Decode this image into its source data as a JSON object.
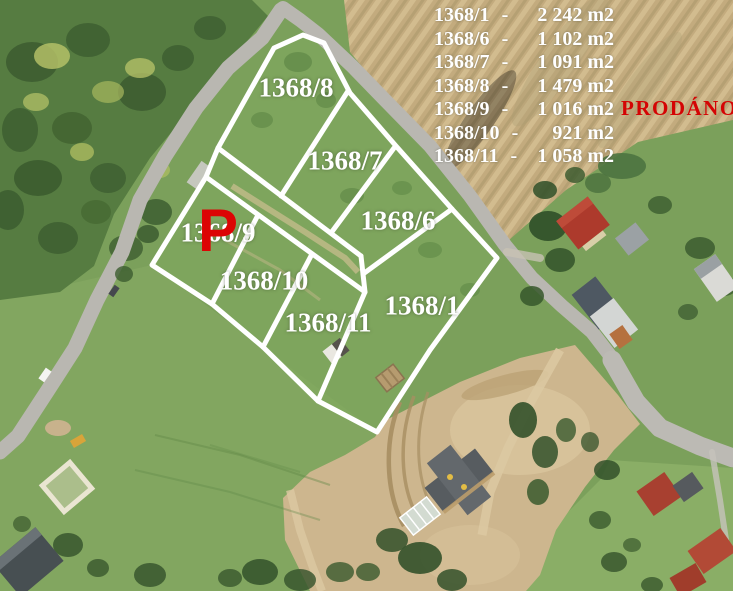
{
  "colors": {
    "grass": "#7ba05b",
    "forest": "#567c41",
    "plowed_field": "#c3ab7e",
    "road": "#b9b7b1",
    "construction_dirt": "#cdb68e",
    "boundary_line": "#ffffff",
    "label_text": "#ffffff",
    "sold_red": "#d40404"
  },
  "legend": {
    "rows": [
      {
        "id": "1368/1",
        "dash": "-",
        "area": "2 242 m2"
      },
      {
        "id": "1368/6",
        "dash": "-",
        "area": "1 102 m2"
      },
      {
        "id": "1368/7",
        "dash": "-",
        "area": "1 091 m2"
      },
      {
        "id": "1368/8",
        "dash": "-",
        "area": "1 479 m2"
      },
      {
        "id": "1368/9",
        "dash": "-",
        "area": "1 016 m2"
      },
      {
        "id": "1368/10",
        "dash": "-",
        "area": "921 m2"
      },
      {
        "id": "1368/11",
        "dash": "-",
        "area": "1 058 m2"
      }
    ],
    "sold_note": "PRODÁNO"
  },
  "map": {
    "labels": [
      {
        "text": "1368/8"
      },
      {
        "text": "1368/7"
      },
      {
        "text": "1368/6"
      },
      {
        "text": "1368/9"
      },
      {
        "text": "1368/10"
      },
      {
        "text": "1368/11"
      },
      {
        "text": "1368/1"
      }
    ],
    "sold_marker": "P"
  }
}
